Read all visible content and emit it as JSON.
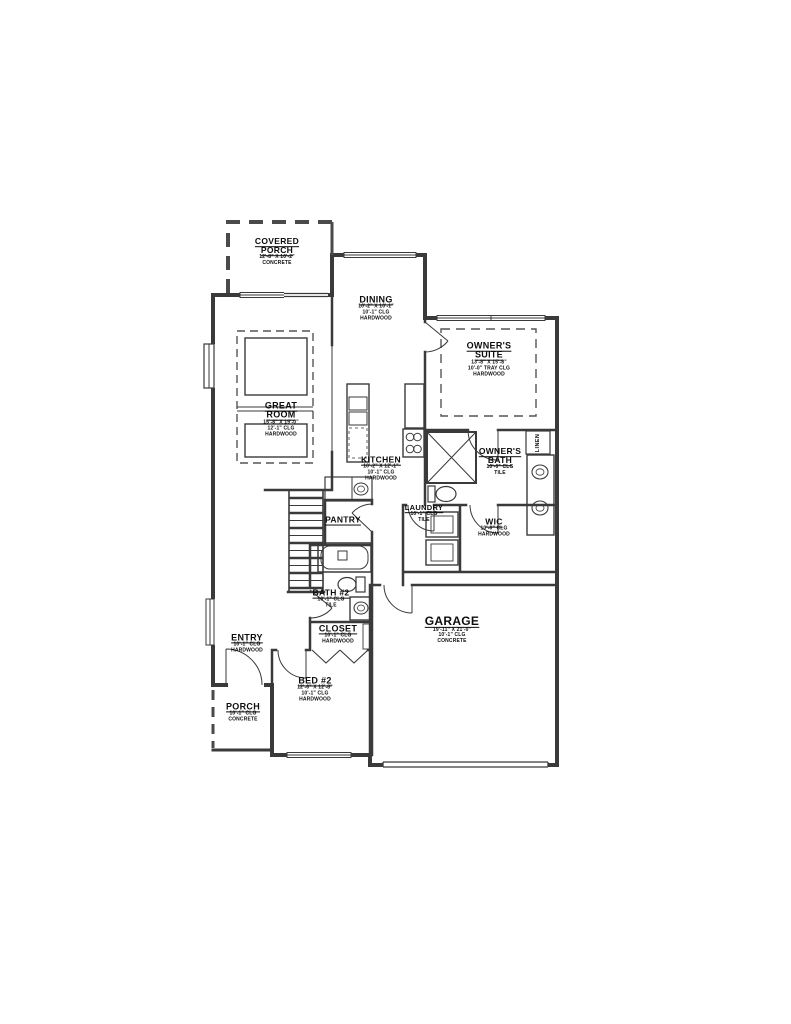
{
  "drawing": {
    "type": "residential-floor-plan",
    "wall_color": "#3a3a3a",
    "accent_dashed_color": "#555555",
    "background": "#ffffff"
  },
  "rooms": {
    "covered_porch": {
      "name": "COVERED PORCH",
      "dims": "12'-8\" X 10'-2\"",
      "floor": "CONCRETE"
    },
    "dining": {
      "name": "DINING",
      "dims": "10'-2\" X 10'-1\"",
      "ceiling": "10'-1\" CLG",
      "floor": "HARDWOOD"
    },
    "owners_suite": {
      "name": "OWNER'S SUITE",
      "dims": "13'-8\" X 15'-8\"",
      "ceiling": "10'-0\" TRAY CLG",
      "floor": "HARDWOOD"
    },
    "great_room": {
      "name": "GREAT ROOM",
      "dims": "15'-8\" X 19'-0\"",
      "ceiling": "12'-1\" CLG",
      "floor": "HARDWOOD"
    },
    "kitchen": {
      "name": "KITCHEN",
      "dims": "10'-2\" X 12'-1\"",
      "ceiling": "10'-1\" CLG",
      "floor": "HARDWOOD"
    },
    "owners_bath": {
      "name": "OWNER'S BATH",
      "ceiling": "10'-0\" CLG",
      "floor": "TILE"
    },
    "linen": {
      "name": "LINEN"
    },
    "pantry": {
      "name": "PANTRY"
    },
    "laundry": {
      "name": "LAUNDRY",
      "ceiling": "10'-1\" CLG",
      "floor": "TILE"
    },
    "wic": {
      "name": "WIC",
      "ceiling": "10'-0\" CLG",
      "floor": "HARDWOOD"
    },
    "bath2": {
      "name": "BATH #2",
      "ceiling": "10'-1\" CLG",
      "floor": "TILE"
    },
    "entry": {
      "name": "ENTRY",
      "ceiling": "10'-1\" CLG",
      "floor": "HARDWOOD"
    },
    "closet": {
      "name": "CLOSET",
      "ceiling": "10'-1\" CLG",
      "floor": "HARDWOOD"
    },
    "garage": {
      "name": "GARAGE",
      "dims": "19'-11\" X 21'-0\"",
      "ceiling": "10'-1\" CLG",
      "floor": "CONCRETE"
    },
    "bed2": {
      "name": "BED #2",
      "dims": "12'-6\" X 12'-8\"",
      "ceiling": "10'-1\" CLG",
      "floor": "HARDWOOD"
    },
    "porch": {
      "name": "PORCH",
      "ceiling": "10'-1\" CLG",
      "floor": "CONCRETE"
    }
  }
}
